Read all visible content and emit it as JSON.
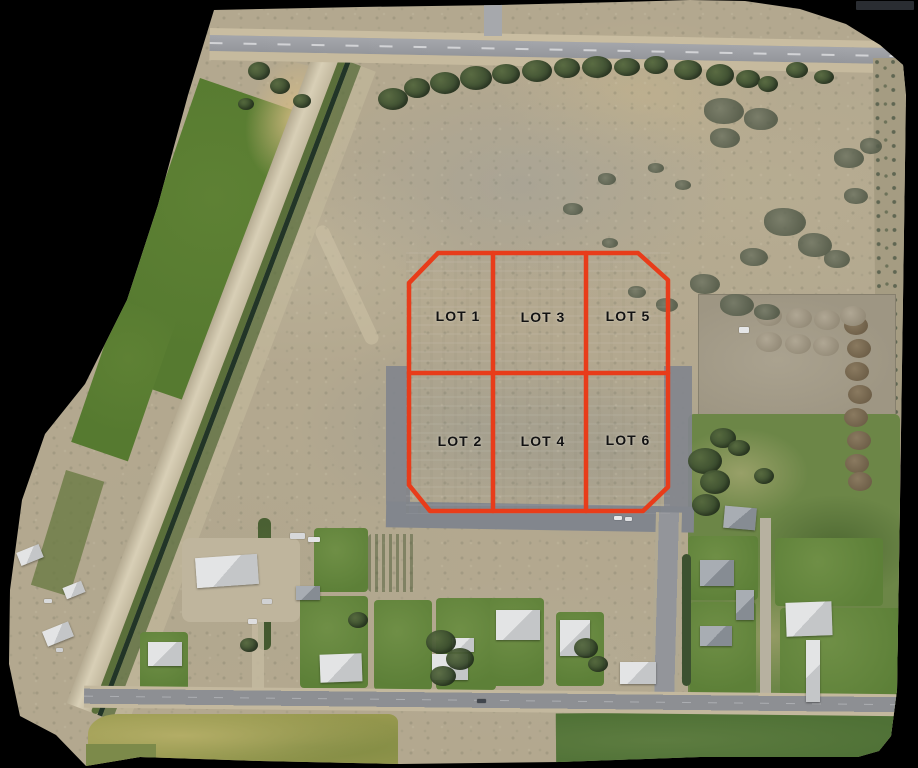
{
  "image": {
    "lots": [
      {
        "id": "lot-1",
        "label": "LOT 1"
      },
      {
        "id": "lot-2",
        "label": "LOT 2"
      },
      {
        "id": "lot-3",
        "label": "LOT 3"
      },
      {
        "id": "lot-4",
        "label": "LOT 4"
      },
      {
        "id": "lot-5",
        "label": "LOT 5"
      },
      {
        "id": "lot-6",
        "label": "LOT 6"
      }
    ],
    "overlay": {
      "line_color": "#e83c1a",
      "label_color": "#121212"
    }
  },
  "scene": {
    "background_color": "#000000",
    "terrain_color": "#b3a88f",
    "field_green": "#567a30",
    "lawn_green": "#5d8038",
    "canal_color": "#223527",
    "highway_color": "#9ea0a5",
    "local_road_color": "#82868d",
    "roof_light": "#d9dadb",
    "roof_gray": "#979da4"
  }
}
